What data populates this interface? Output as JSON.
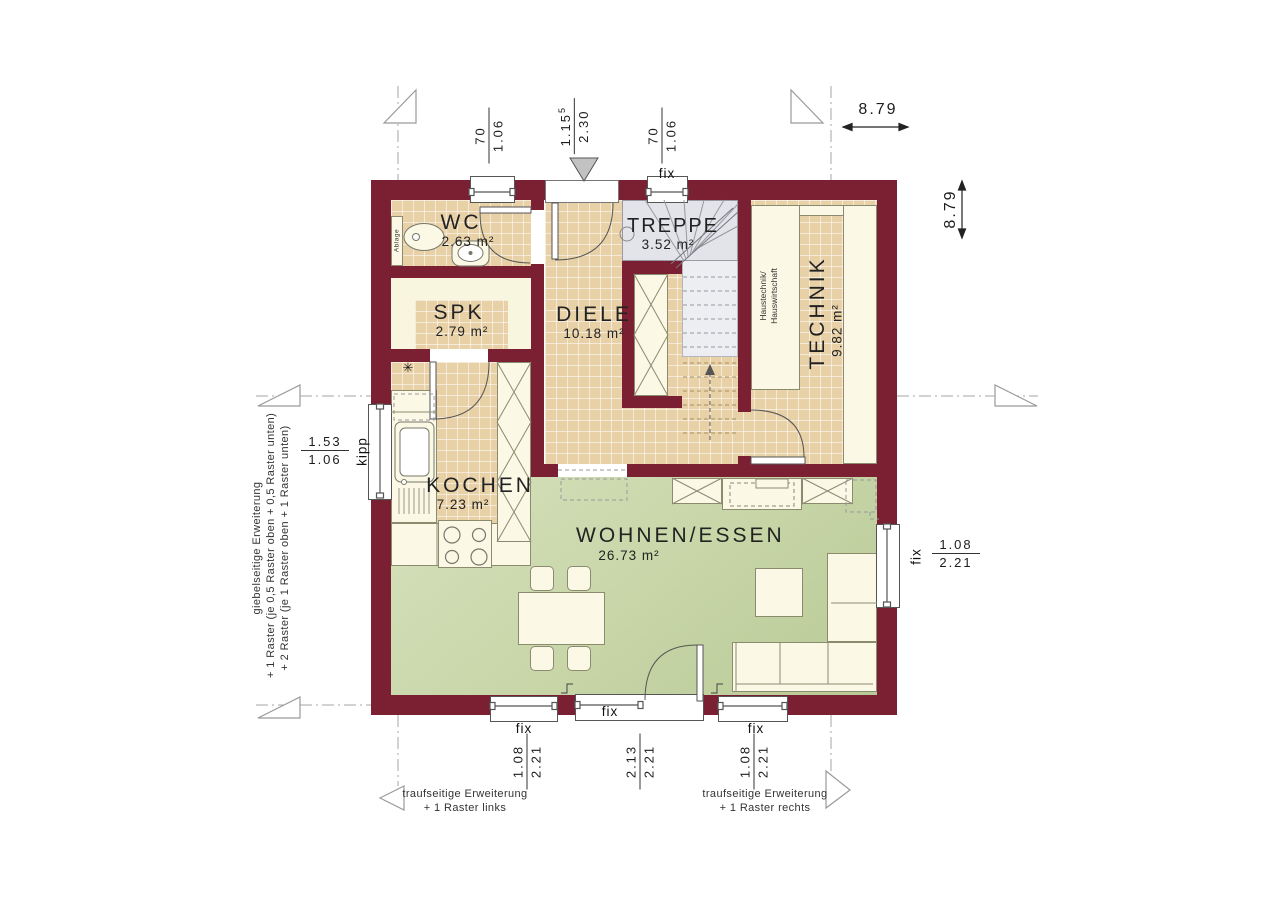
{
  "plan": {
    "rooms": {
      "wc": {
        "name": "WC",
        "area": "2.63 m²"
      },
      "spk": {
        "name": "SPK",
        "area": "2.79 m²"
      },
      "diele": {
        "name": "DIELE",
        "area": "10.18 m²"
      },
      "treppe": {
        "name": "TREPPE",
        "area": "3.52 m²"
      },
      "technik": {
        "name": "TECHNIK",
        "area": "9.82 m²",
        "note_line1": "Haustechnik/",
        "note_line2": "Hauswirtschaft"
      },
      "kochen": {
        "name": "KOCHEN",
        "area": "7.23 m²"
      },
      "wohnen": {
        "name": "WOHNEN/ESSEN",
        "area": "26.73 m²"
      }
    },
    "fixtures": {
      "wc_shelf": "Ablage",
      "kitchen_marker": "✳"
    },
    "window_labels": {
      "fix": "fix",
      "kipp": "kipp"
    },
    "dimensions": {
      "overall_width": "8.79",
      "overall_height": "8.79",
      "top": [
        {
          "w": "70",
          "h": "1.06"
        },
        {
          "w": "1.15",
          "w_sup": "5",
          "h": "2.30"
        },
        {
          "w": "70",
          "h": "1.06"
        }
      ],
      "bottom": [
        {
          "w": "1.08",
          "h": "2.21"
        },
        {
          "w": "2.13",
          "h": "2.21"
        },
        {
          "w": "1.08",
          "h": "2.21"
        }
      ],
      "left": {
        "w": "1.53",
        "h": "1.06"
      },
      "right": {
        "w": "1.08",
        "h": "2.21"
      }
    },
    "annotations": {
      "left_vertical": [
        "giebelseitige Erweiterung",
        "+ 1 Raster (je 0,5 Raster oben + 0,5 Raster unten)",
        "+ 2 Raster (je 1 Raster oben + 1 Raster unten)"
      ],
      "bottom_left": [
        "traufseitige Erweiterung",
        "+ 1 Raster links"
      ],
      "bottom_right": [
        "traufseitige Erweiterung",
        "+ 1 Raster rechts"
      ]
    },
    "colors": {
      "wall": "#7b2033",
      "tile": "#e9d1a7",
      "living": "#c7d5a7",
      "cream": "#f9f6e0",
      "stair": "#e2e4e9"
    }
  }
}
